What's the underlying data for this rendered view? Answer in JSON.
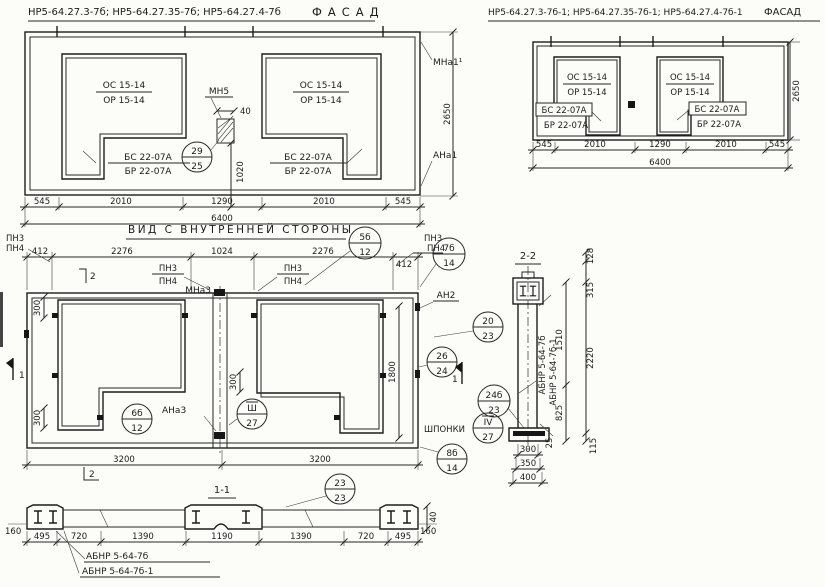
{
  "colors": {
    "ink": "#1b1b1b",
    "paper": "#fcfcf9"
  },
  "opening_labels": {
    "os": "ОС 15-14",
    "or": "ОР 15-14",
    "bs": "БС 22-07А",
    "br": "БР 22-07А"
  },
  "facade_left": {
    "title": "НР5-64.27.3-7б; НР5-64.27.35-7б; НР5-64.27.4-7б",
    "title_suffix": "ФАСАД",
    "row_dims": [
      "545",
      "2010",
      "1290",
      "2010",
      "545"
    ],
    "total": "6400",
    "height": "2650",
    "mna1": "МНа1¹",
    "ana1": "АНа1",
    "mn5": "МН5",
    "mn5_w": "40",
    "mn5_h": "1020",
    "node29": {
      "num": "29",
      "sheet": "25"
    }
  },
  "facade_right": {
    "title": "НР5-64.27.3-7б-1; НР5-64.27.35-7б-1; НР5-64.27.4-7б-1",
    "title_suffix": "ФАСАД",
    "row_dims": [
      "545",
      "2010",
      "1290",
      "2010",
      "545"
    ],
    "total": "6400",
    "height": "2650"
  },
  "inner_view": {
    "title": "ВИД С ВНУТРЕННЕЙ СТОРОНЫ",
    "top_dims": [
      "412",
      "2276",
      "1024",
      "2276",
      "412"
    ],
    "bottom_dims": [
      "3200",
      "3200"
    ],
    "pn3": "ПН3",
    "pn4": "ПН4",
    "mna3": "МНа3",
    "ana3": "АНа3",
    "an2": "АН2",
    "shponki": "ШПОНКИ",
    "dim300": "300",
    "dim1800": "1800",
    "marker1": "1",
    "marker2": "2",
    "nodes": {
      "n5b": {
        "num": "5б",
        "sheet": "12"
      },
      "n7b": {
        "num": "7б",
        "sheet": "14"
      },
      "n6b": {
        "num": "6б",
        "sheet": "12"
      },
      "n8b": {
        "num": "8б",
        "sheet": "14"
      },
      "n3": {
        "num": "Ш",
        "sheet": "27"
      },
      "n4": {
        "num": "IV",
        "sheet": "27"
      },
      "n20": {
        "num": "20",
        "sheet": "23"
      },
      "n26": {
        "num": "26",
        "sheet": "24"
      },
      "n24b": {
        "num": "24б",
        "sheet": "23"
      }
    }
  },
  "section11": {
    "title": "1-1",
    "node23": {
      "num": "23",
      "sheet": "23"
    },
    "dims": [
      "495",
      "720",
      "1390",
      "1190",
      "1390",
      "720",
      "495"
    ],
    "end_dim": "160",
    "height_dim": "40",
    "label1": "АБНР 5-64-7б",
    "label2": "АБНР 5-64-7б-1"
  },
  "section22": {
    "title": "2-2",
    "right_dims": [
      "128",
      "315",
      "2220",
      "115"
    ],
    "inner_dims": [
      "1510",
      "825",
      "25"
    ],
    "bottom_dims": [
      "300",
      "350",
      "400"
    ],
    "label1": "АБНР 5-64-7б",
    "label2": "АБНР 5-64-7б-1"
  }
}
